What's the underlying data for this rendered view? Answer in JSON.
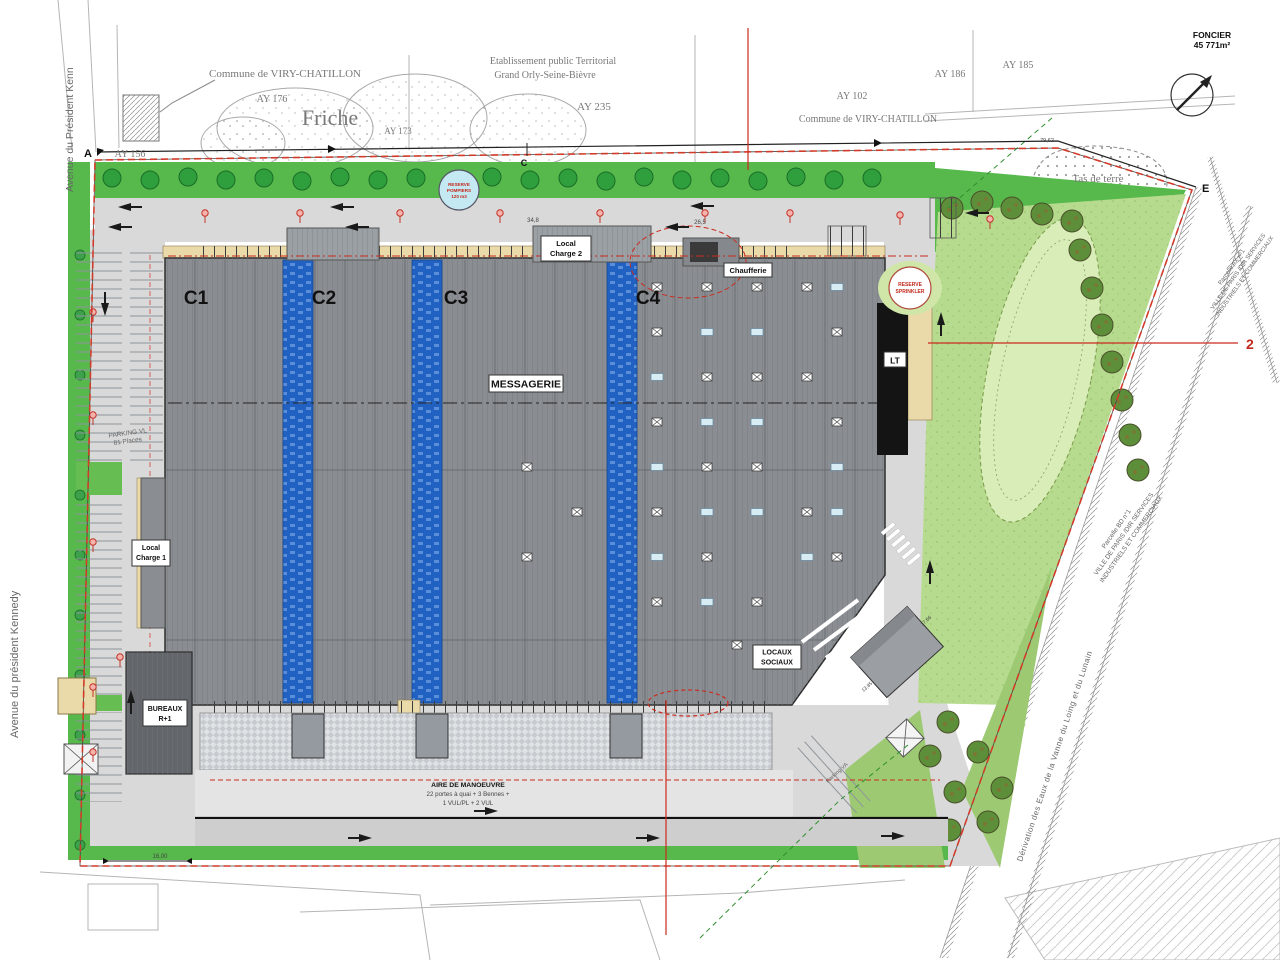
{
  "streets": {
    "avenue_top": "Avenue du Président Kenn",
    "avenue_left": "Avenue du président Kennedy",
    "aqueduct": "Dérivation des Eaux de la Vanne du Loing et du Lunain"
  },
  "communes": {
    "northwest": "Commune de VIRY-CHATILLON",
    "northeast": "Commune de VIRY-CHATILLON",
    "ept_line1": "Etablissement public Territorial",
    "ept_line2": "Grand Orly-Seine-Bièvre"
  },
  "parcels": {
    "ay156": "AY 156",
    "ay176": "AY 176",
    "ay173": "AY 173",
    "ay235": "AY 235",
    "ay102": "AY 102",
    "ay186": "AY 186",
    "ay185": "AY 185",
    "friche": "Friche",
    "tas_de_terre": "Tas de terre",
    "parcelle_bd": "Parcelle BD n°1",
    "parcelle_ax": "Parcelle AX n°1",
    "ville_line1": "VILLE DE PARIS /DIR SERVICES",
    "ville_line2": "INDUSTRIELS ET COMMERCIAUX"
  },
  "foncier": {
    "label": "FONCIER",
    "area": "45 771m²"
  },
  "points": {
    "a": "A",
    "c": "C",
    "e": "E",
    "ref2": "2"
  },
  "building": {
    "cells": [
      {
        "label": "C1"
      },
      {
        "label": "C2"
      },
      {
        "label": "C3"
      },
      {
        "label": "C4"
      }
    ],
    "messagerie": "MESSAGERIE",
    "local_charge_1_l1": "Local",
    "local_charge_1_l2": "Charge 1",
    "local_charge_2_l1": "Local",
    "local_charge_2_l2": "Charge 2",
    "chaufferie": "Chaufferie",
    "lt": "LT",
    "locaux_l1": "LOCAUX",
    "locaux_l2": "SOCIAUX",
    "bureaux_l1": "BUREAUX",
    "bureaux_l2": "R+1"
  },
  "site": {
    "reserve_pompiers_l1": "RESERVE",
    "reserve_pompiers_l2": "POMPIERS",
    "reserve_pompiers_l3": "120 m3",
    "reserve_sprinkler_l1": "RESERVE",
    "reserve_sprinkler_l2": "SPRINKLER",
    "parking_vl_l1": "PARKING VL",
    "parking_vl_l2": "81 Places",
    "parking_va": "Parking VA",
    "aire_l1": "AIRE DE MANOEUVRE",
    "aire_l2": "22 portes à quai + 3 Bennes +",
    "aire_l3": "1 VUL/PL + 2 VUL"
  },
  "dims": {
    "d34_8": "34,8",
    "d26_5": "26,5",
    "d79_62": "79,62",
    "d16_00": "16,00",
    "d17_66": "17,66",
    "d13_85": "13,85"
  },
  "colors": {
    "boundary_red": "#cc2a1e",
    "building_gray": "#8a8e92",
    "mezzanine_blue": "#2061c2",
    "greenery": "#57b84c",
    "meadow": "#b7db8e",
    "road": "#d9d9d9",
    "wall_beige": "#ead9a9",
    "reserve_cyan": "#c5e9f2"
  }
}
